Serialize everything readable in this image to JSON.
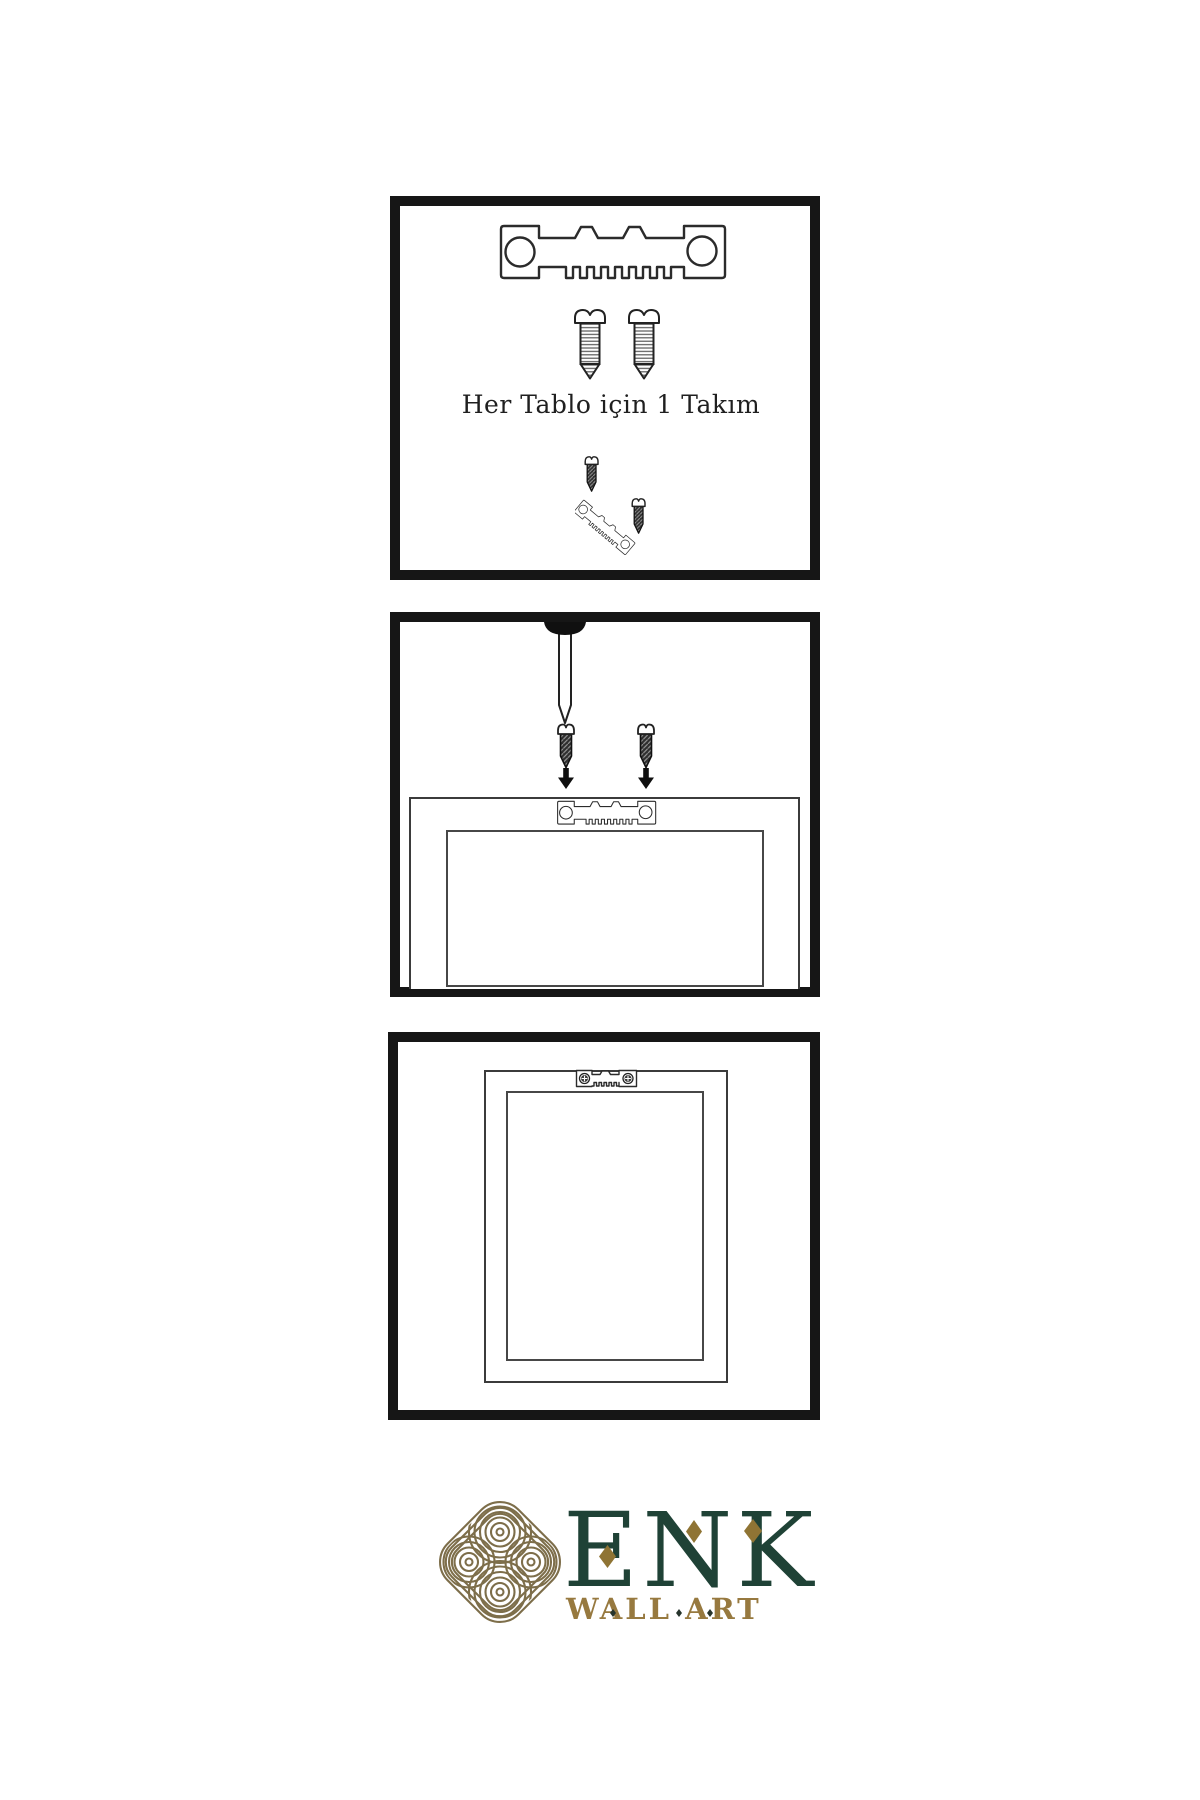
{
  "sheet": {
    "background": "#ffffff",
    "step1_caption": "Her Tablo için 1 Takım"
  },
  "steps": [
    {
      "name": "kit-contents",
      "items": [
        "sawtooth-hanger",
        "screw",
        "screw"
      ]
    },
    {
      "name": "attach-hanger-to-frame-back",
      "items": [
        "wall-nail",
        "screw",
        "screw",
        "sawtooth-hanger-on-frame"
      ]
    },
    {
      "name": "frame-hung-on-wall",
      "items": [
        "frame-back-with-mounted-hanger"
      ]
    }
  ],
  "logo": {
    "wordmark": "ENK",
    "tagline": "WALL ART",
    "colors": {
      "wordmark_green": "#1f4236",
      "tagline_gold": "#97793f",
      "knot_gold": "#7d6e4a",
      "diamond_gold": "#8f7434"
    }
  }
}
